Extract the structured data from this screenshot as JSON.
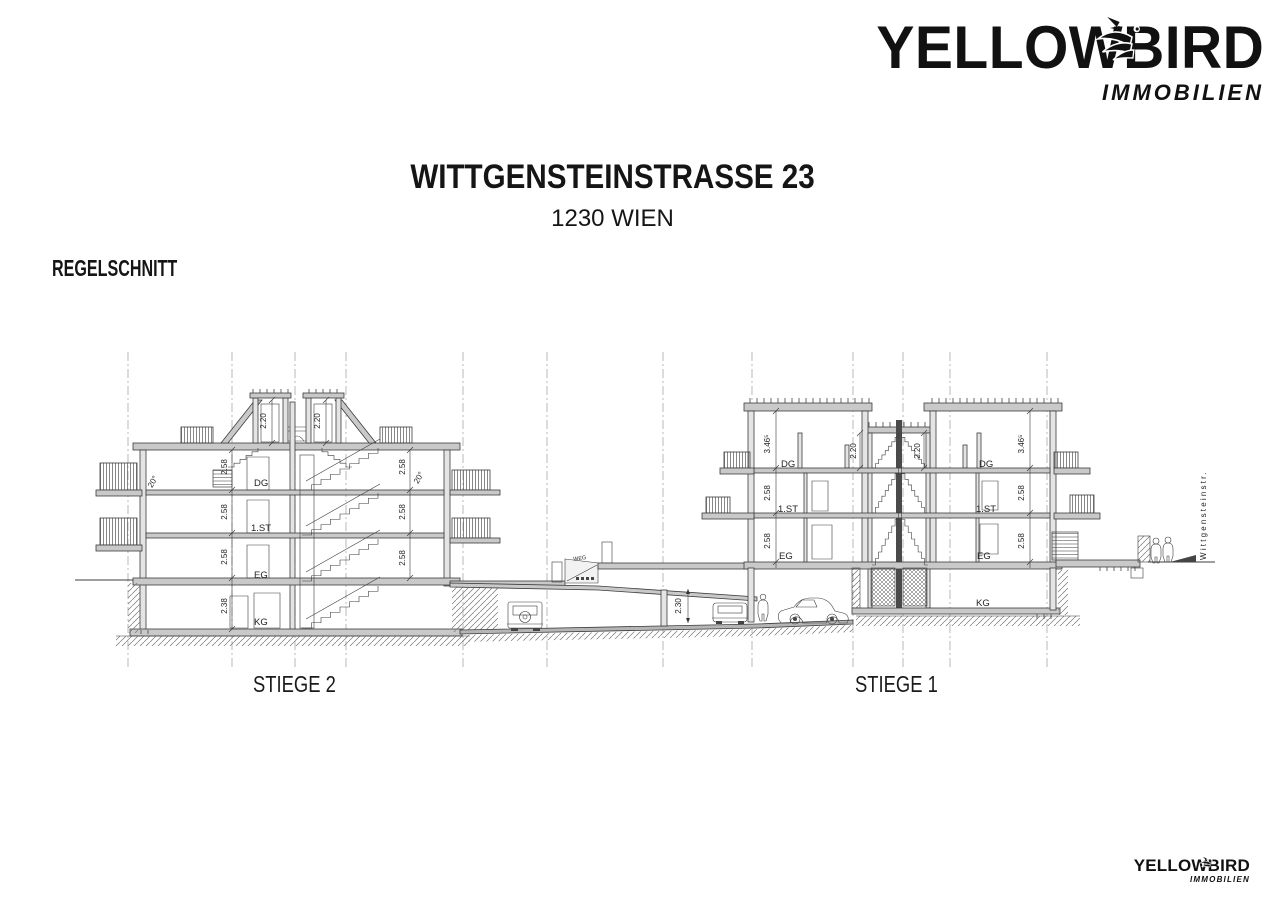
{
  "brand": {
    "word_left": "YELLOW",
    "bird_letter": "B",
    "word_right": "IRD",
    "subtitle": "IMMOBILIEN",
    "color": "#111111"
  },
  "title": {
    "line1": "WITTGENSTEINSTRASSE 23",
    "line2": "1230 WIEN"
  },
  "section_label": "REGELSCHNITT",
  "drawing": {
    "building_left_label": "STIEGE 2",
    "building_right_label": "STIEGE 1",
    "path_label": "WEG",
    "street_label": "Wittgensteinstr.",
    "floors": {
      "dg": "DG",
      "first": "1.ST",
      "eg": "EG",
      "kg": "KG"
    },
    "dims": {
      "d220": "2.20",
      "d258": "2.58",
      "d238": "2.38",
      "d230": "2.30",
      "d346": "3.46⁵",
      "a20": "20°"
    },
    "colors": {
      "line": "#3c3c3c",
      "grid": "#9a9a9a",
      "slab_fill": "#c9c9c9"
    }
  }
}
